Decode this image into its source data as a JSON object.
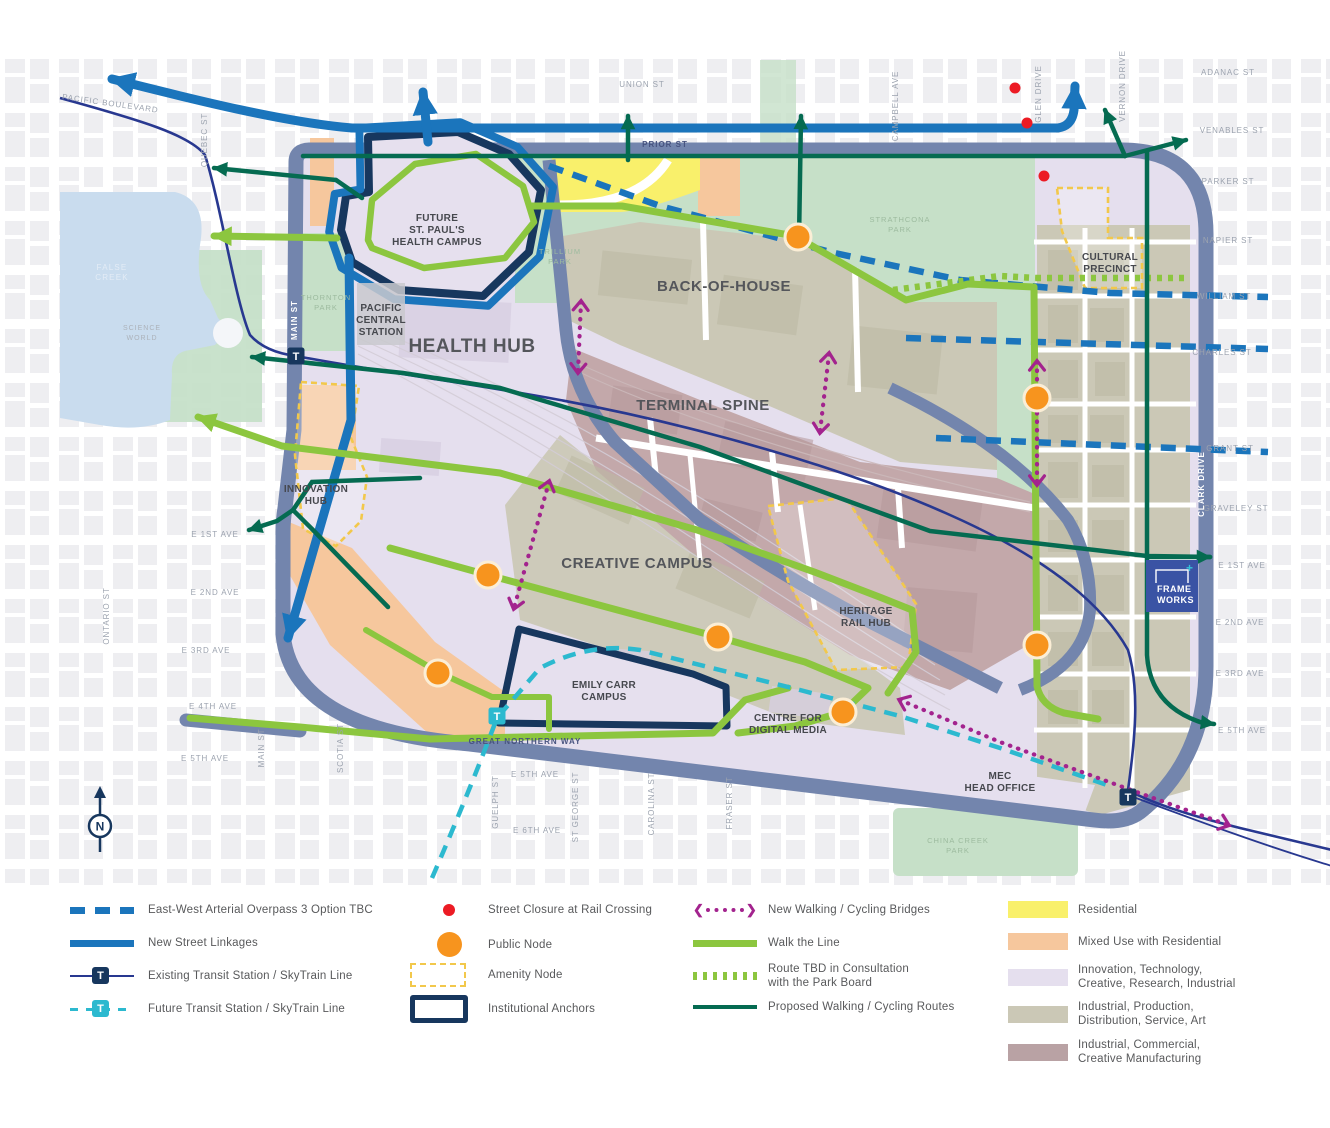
{
  "colors": {
    "slate_road": "#7385AD",
    "new_street_blue": "#1B75BC",
    "anchor_navy": "#17375E",
    "skytrain_navy": "#283890",
    "future_cyan": "#2CB9CF",
    "walk_line_green": "#8CC63F",
    "proposed_dark_green": "#056B51",
    "bridge_magenta": "#A3238E",
    "closure_red": "#EC1B24",
    "node_orange": "#F7941E",
    "residential_yellow": "#F9F06B",
    "mixed_use_peach": "#F6C79D",
    "innovation_lavender": "#E5DFEE",
    "industrial_taupe": "#CBC8B6",
    "industrial_mauve": "#C3A8AA",
    "park_green": "#C3DFC6",
    "water_blue": "#C9DCEE",
    "amenity_yellow": "#F2C84B"
  },
  "map": {
    "transit_t": "T",
    "compass_n": "N",
    "logo": {
      "line1": "FRAME",
      "line2": "WORKS",
      "plus": "+"
    },
    "districts": {
      "health_hub": "HEALTH HUB",
      "back_of_house": "BACK-OF-HOUSE",
      "terminal_spine": "TERMINAL SPINE",
      "creative_campus": "CREATIVE CAMPUS",
      "innovation_hub_1": "INNOVATION",
      "innovation_hub_2": "HUB",
      "cultural_precinct_1": "CULTURAL",
      "cultural_precinct_2": "PRECINCT",
      "heritage_rail_hub_1": "HERITAGE",
      "heritage_rail_hub_2": "RAIL HUB"
    },
    "places": {
      "st_pauls_1": "FUTURE",
      "st_pauls_2": "ST. PAUL'S",
      "st_pauls_3": "HEALTH CAMPUS",
      "pacific_central_1": "PACIFIC",
      "pacific_central_2": "CENTRAL",
      "pacific_central_3": "STATION",
      "emily_carr_1": "EMILY CARR",
      "emily_carr_2": "CAMPUS",
      "cdm_1": "CENTRE FOR",
      "cdm_2": "DIGITAL MEDIA",
      "mec_1": "MEC",
      "mec_2": "HEAD OFFICE",
      "science_world_1": "SCIENCE",
      "science_world_2": "WORLD",
      "false_creek_1": "FALSE",
      "false_creek_2": "CREEK"
    },
    "parks": {
      "strathcona_1": "STRATHCONA",
      "strathcona_2": "PARK",
      "trillium_1": "TRILLIUM",
      "trillium_2": "PARK",
      "thornton_1": "THORNTON",
      "thornton_2": "PARK",
      "china_creek_1": "CHINA CREEK",
      "china_creek_2": "PARK"
    },
    "streets": {
      "pacific_boulevard": "PACIFIC BOULEVARD",
      "union": "UNION ST",
      "prior": "PRIOR ST",
      "adanac": "ADANAC ST",
      "venables": "VENABLES ST",
      "parker": "PARKER ST",
      "napier": "NAPIER ST",
      "william": "WILLIAM ST",
      "charles": "CHARLES ST",
      "grant": "GRANT ST",
      "graveley": "GRAVELEY ST",
      "e1": "E 1ST AVE",
      "e2": "E 2ND AVE",
      "e3": "E 3RD AVE",
      "e4": "E 4TH AVE",
      "e5": "E 5TH AVE",
      "e6": "E 6TH AVE",
      "great_northern_way": "GREAT NORTHERN WAY",
      "quebec": "QUEBEC ST",
      "main": "MAIN ST",
      "ontario": "ONTARIO ST",
      "scotia": "SCOTIA ST",
      "guelph": "GUELPH ST",
      "st_george": "ST GEORGE ST",
      "carolina": "CAROLINA ST",
      "fraser": "FRASER ST",
      "campbell": "CAMPBELL AVE",
      "glen": "GLEN DRIVE",
      "vernon": "VERNON DRIVE",
      "clark": "CLARK DRIVE"
    }
  },
  "legend": {
    "col1": [
      {
        "label": "East-West Arterial Overpass 3 Option TBC"
      },
      {
        "label": "New Street Linkages"
      },
      {
        "label": "Existing Transit Station / SkyTrain Line"
      },
      {
        "label": "Future Transit Station / SkyTrain Line"
      }
    ],
    "col2": [
      {
        "label": "Street Closure at Rail Crossing"
      },
      {
        "label": "Public Node"
      },
      {
        "label": "Amenity Node"
      },
      {
        "label": "Institutional Anchors"
      }
    ],
    "col3": [
      {
        "label": "New Walking / Cycling Bridges"
      },
      {
        "label": "Walk the Line"
      },
      {
        "label": "Route TBD in Consultation",
        "label2": "with the Park Board"
      },
      {
        "label": "Proposed Walking / Cycling Routes"
      }
    ],
    "col4": [
      {
        "label": "Residential"
      },
      {
        "label": "Mixed Use with Residential"
      },
      {
        "label": "Innovation, Technology,",
        "label2": "Creative, Research, Industrial"
      },
      {
        "label": "Industrial, Production,",
        "label2": "Distribution, Service, Art"
      },
      {
        "label": "Industrial, Commercial,",
        "label2": "Creative Manufacturing"
      }
    ]
  }
}
